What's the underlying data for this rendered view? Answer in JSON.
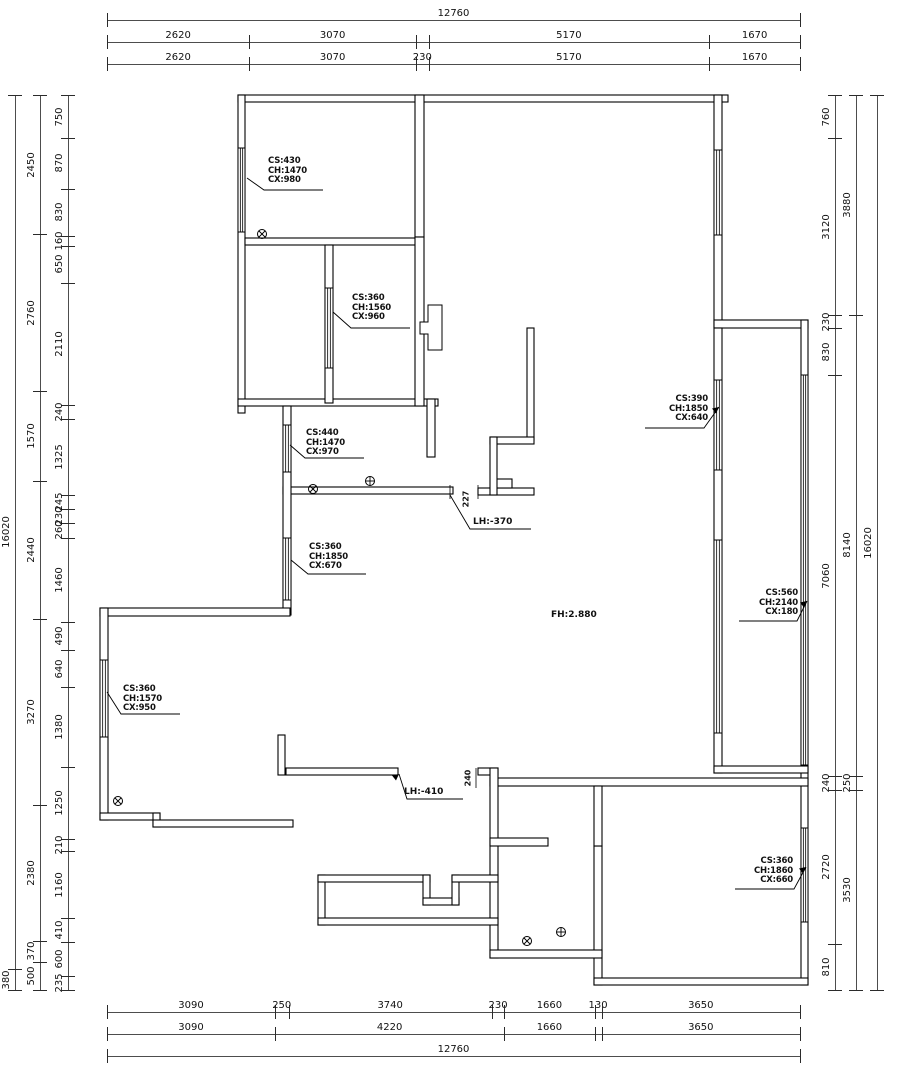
{
  "drawing": {
    "type": "floor-plan",
    "units": "mm",
    "colors": {
      "wall_line": "#000000",
      "dim_line": "#4d4d4d",
      "text": "#111111",
      "background": "#ffffff"
    }
  },
  "dims": {
    "top": [
      [
        {
          "t": "12760"
        }
      ],
      [
        {
          "t": "2620"
        },
        {
          "t": "3070"
        },
        {
          "t": "",
          "v": 230
        },
        {
          "t": "5170"
        },
        {
          "t": "1670"
        }
      ],
      [
        {
          "t": "2620"
        },
        {
          "t": "3070"
        },
        {
          "t": "230"
        },
        {
          "t": "5170"
        },
        {
          "t": "1670"
        }
      ]
    ],
    "bottom": [
      [
        {
          "t": "3090"
        },
        {
          "t": "250"
        },
        {
          "t": "3740"
        },
        {
          "t": "230"
        },
        {
          "t": "1660"
        },
        {
          "t": "130"
        },
        {
          "t": "3650"
        }
      ],
      [
        {
          "t": "3090"
        },
        {
          "t": "4220"
        },
        {
          "t": "1660"
        },
        {
          "t": "",
          "v": 130
        },
        {
          "t": "3650"
        }
      ],
      [
        {
          "t": "12760"
        }
      ]
    ],
    "left": [
      [
        {
          "t": "16020"
        },
        {
          "t": "380"
        }
      ],
      [
        {
          "t": "2450"
        },
        {
          "t": "2760"
        },
        {
          "t": "1570"
        },
        {
          "t": "2440"
        },
        {
          "t": "3270"
        },
        {
          "t": "2380"
        },
        {
          "t": "370"
        },
        {
          "t": "500"
        }
      ],
      [
        {
          "t": "750"
        },
        {
          "t": "870"
        },
        {
          "t": "830"
        },
        {
          "t": "160"
        },
        {
          "t": "650"
        },
        {
          "t": "2110"
        },
        {
          "t": "240"
        },
        {
          "t": "1325"
        },
        {
          "t": "245"
        },
        {
          "t": "230"
        },
        {
          "t": "260"
        },
        {
          "t": "1460"
        },
        {
          "t": "490"
        },
        {
          "t": "640"
        },
        {
          "t": "1380"
        },
        {
          "t": "1250"
        },
        {
          "t": "210"
        },
        {
          "t": "1160"
        },
        {
          "t": "410"
        },
        {
          "t": "600"
        },
        {
          "t": "235"
        }
      ]
    ],
    "right": [
      [
        {
          "t": "760"
        },
        {
          "t": "3120"
        },
        {
          "t": "230"
        },
        {
          "t": "830"
        },
        {
          "t": "7060"
        },
        {
          "t": "240"
        },
        {
          "t": "2720"
        },
        {
          "t": "810"
        }
      ],
      [
        {
          "t": "3880"
        },
        {
          "t": "8140"
        },
        {
          "t": "250"
        },
        {
          "t": "3530"
        }
      ],
      [
        {
          "t": "16020"
        }
      ]
    ]
  },
  "window_labels": [
    {
      "lines": [
        "CS:430",
        "CH:1470",
        "CX:980"
      ]
    },
    {
      "lines": [
        "CS:360",
        "CH:1560",
        "CX:960"
      ]
    },
    {
      "lines": [
        "CS:440",
        "CH:1470",
        "CX:970"
      ]
    },
    {
      "lines": [
        "CS:390",
        "CH:1850",
        "CX:640"
      ]
    },
    {
      "lines": [
        "CS:360",
        "CH:1850",
        "CX:670"
      ]
    },
    {
      "lines": [
        "CS:560",
        "CH:2140",
        "CX:180"
      ]
    },
    {
      "lines": [
        "CS:360",
        "CH:1570",
        "CX:950"
      ]
    },
    {
      "lines": [
        "CS:360",
        "CH:1860",
        "CX:660"
      ]
    }
  ],
  "annotations": {
    "floor_height": "FH:2.880",
    "lh_upper": "LH:-370",
    "lh_lower": "LH:-410",
    "gap_upper": "227",
    "gap_lower": "240"
  },
  "symbols": {
    "circle_cross": "circle-cross-symbol",
    "circle_plus": "circle-plus-symbol"
  }
}
